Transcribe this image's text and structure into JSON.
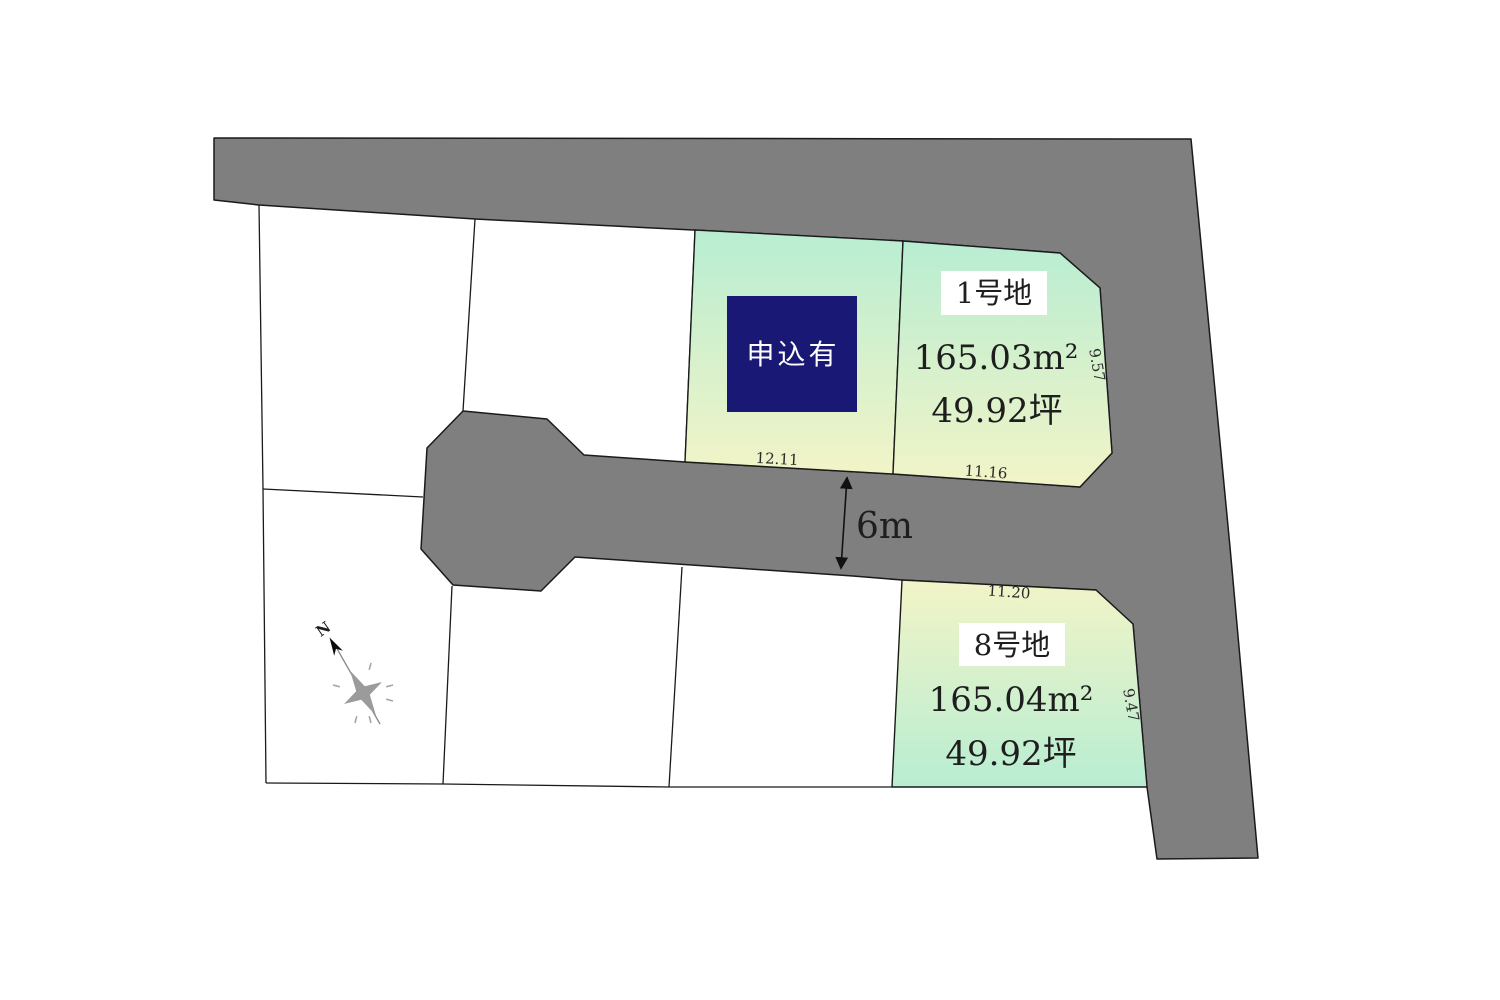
{
  "road": {
    "width_label": "6m",
    "fill": "#7f7f7f"
  },
  "compass": {
    "north_label": "N"
  },
  "lots": {
    "applied": {
      "status": "申込有",
      "dim_bottom": "12.11"
    },
    "lot1": {
      "name": "1号地",
      "area_sqm": "165.03m²",
      "area_tsubo": "49.92坪",
      "dim_bottom": "11.16",
      "dim_right": "9.57"
    },
    "lot8": {
      "name": "8号地",
      "area_sqm": "165.04m²",
      "area_tsubo": "49.92坪",
      "dim_top": "11.20",
      "dim_right": "9.47"
    }
  },
  "colors": {
    "road": "#7f7f7f",
    "lot_gradient_green": "#b8edd2",
    "lot_gradient_yellow": "#f2f4c7",
    "applied_box": "#191975",
    "outline": "#1a1a1a"
  }
}
